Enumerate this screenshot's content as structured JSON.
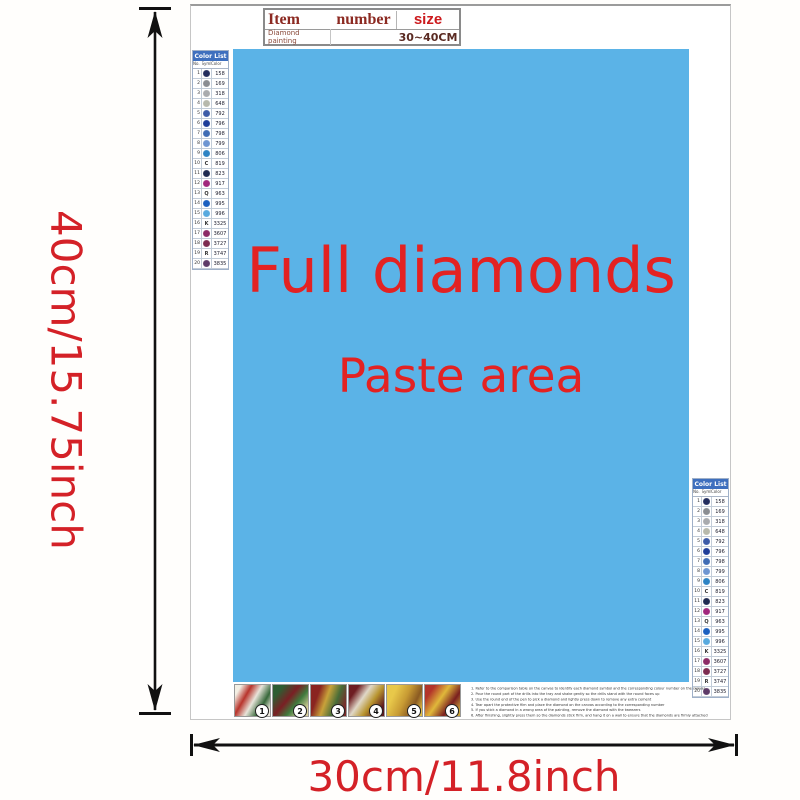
{
  "dimensions": {
    "height_label": "40cm/15.75inch",
    "width_label": "30cm/11.8inch",
    "label_color": "#d42127"
  },
  "item_table": {
    "header": {
      "item": "Item",
      "number": "number",
      "size": "size"
    },
    "row": {
      "item": "Diamond painting",
      "number": "",
      "size": "30~40CM"
    }
  },
  "paste_area": {
    "line1": "Full diamonds",
    "line2": "Paste area",
    "bg": "#5bb3e7",
    "text_color": "#e32222"
  },
  "color_list": {
    "title": "Color List",
    "columns": [
      "No.",
      "Symbol",
      "Color"
    ],
    "header_bg": "#3e6fbe",
    "rows": [
      {
        "no": "1",
        "symbol": "dot",
        "symbol_color": "#232d5e",
        "code": "158"
      },
      {
        "no": "2",
        "symbol": "dot",
        "symbol_color": "#8a8d92",
        "code": "169"
      },
      {
        "no": "3",
        "symbol": "dot",
        "symbol_color": "#a9abae",
        "code": "318"
      },
      {
        "no": "4",
        "symbol": "dot",
        "symbol_color": "#b7b9ac",
        "code": "648"
      },
      {
        "no": "5",
        "symbol": "dot",
        "symbol_color": "#3c5ba8",
        "code": "792"
      },
      {
        "no": "6",
        "symbol": "dot",
        "symbol_color": "#1e3d99",
        "code": "796"
      },
      {
        "no": "7",
        "symbol": "dot",
        "symbol_color": "#3f6cb5",
        "code": "798"
      },
      {
        "no": "8",
        "symbol": "dot",
        "symbol_color": "#6d95d2",
        "code": "799"
      },
      {
        "no": "9",
        "symbol": "dot",
        "symbol_color": "#2d83c4",
        "code": "806"
      },
      {
        "no": "10",
        "symbol": "C",
        "code": "819"
      },
      {
        "no": "11",
        "symbol": "dot",
        "symbol_color": "#1d2950",
        "code": "823"
      },
      {
        "no": "12",
        "symbol": "dot",
        "symbol_color": "#a1277d",
        "code": "917"
      },
      {
        "no": "13",
        "symbol": "Q",
        "code": "963"
      },
      {
        "no": "14",
        "symbol": "dot",
        "symbol_color": "#1a5fc0",
        "code": "995"
      },
      {
        "no": "15",
        "symbol": "dot",
        "symbol_color": "#58aadf",
        "code": "996"
      },
      {
        "no": "16",
        "symbol": "K",
        "code": "3325"
      },
      {
        "no": "17",
        "symbol": "dot",
        "symbol_color": "#8c2a66",
        "code": "3607"
      },
      {
        "no": "18",
        "symbol": "dot",
        "symbol_color": "#7c2b50",
        "code": "3727"
      },
      {
        "no": "19",
        "symbol": "R",
        "code": "3747"
      },
      {
        "no": "20",
        "symbol": "dot",
        "symbol_color": "#5d3a68",
        "code": "3835"
      }
    ]
  },
  "steps": [
    {
      "number": "1"
    },
    {
      "number": "2"
    },
    {
      "number": "3"
    },
    {
      "number": "4"
    },
    {
      "number": "5"
    },
    {
      "number": "6"
    }
  ],
  "instructions": [
    "1. Refer to the comparison table on the canvas to identify each diamond symbol and the corresponding colour number on the canvas",
    "2. Pour the round part of the drills into the tray and shake gently so the drills stand with the round faces up",
    "3. Use the round end of the pen to pick a diamond and lightly press down to remove any extra cement",
    "4. Tear apart the protective film and place the diamond on the canvas according to the corresponding number",
    "5. If you stick a diamond in a wrong area of the painting, remove the diamond with the tweezers",
    "6. After finishing, slightly press them so the diamonds stick firm, and hang it on a wall to ensure that the diamonds are firmly attached"
  ]
}
